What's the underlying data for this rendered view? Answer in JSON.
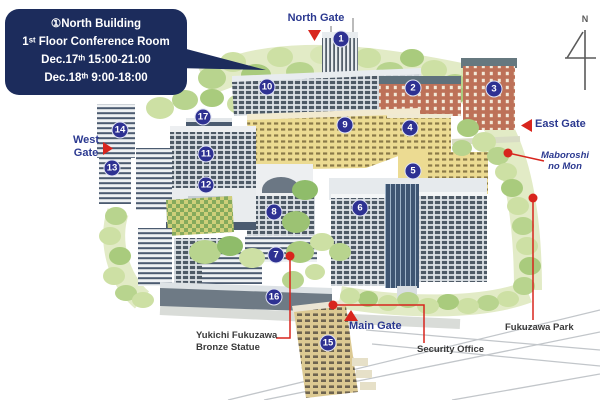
{
  "colors": {
    "marker-bg": "#2e3192",
    "callout-bg": "#1c2c5c",
    "gate-text": "#2b3990",
    "label-text": "#3a3a3a",
    "accent-red": "#d8251d",
    "compass": "#5a5a5a"
  },
  "callout": {
    "line1": "①North Building",
    "line2": "1ˢᵗ Floor Conference Room",
    "line3": "Dec.17ᵗʰ 15:00-21:00",
    "line4": "Dec.18ᵗʰ  9:00-18:00"
  },
  "gates": {
    "north": "North Gate",
    "east": "East Gate",
    "west_line1": "West",
    "west_line2": "Gate",
    "main": "Main Gate"
  },
  "annotations": {
    "maboroshi_line1": "Maboroshi",
    "maboroshi_line2": "no Mon",
    "statue_line1": "Yukichi Fukuzawa",
    "statue_line2": "Bronze Statue",
    "security": "Security Office",
    "park": "Fukuzawa Park"
  },
  "compass": {
    "north_label": "N"
  },
  "markers": [
    {
      "n": "1",
      "x": 341,
      "y": 39
    },
    {
      "n": "2",
      "x": 413,
      "y": 88
    },
    {
      "n": "3",
      "x": 494,
      "y": 89
    },
    {
      "n": "4",
      "x": 410,
      "y": 128
    },
    {
      "n": "5",
      "x": 413,
      "y": 171
    },
    {
      "n": "6",
      "x": 360,
      "y": 208
    },
    {
      "n": "7",
      "x": 276,
      "y": 255
    },
    {
      "n": "8",
      "x": 274,
      "y": 212
    },
    {
      "n": "9",
      "x": 345,
      "y": 125
    },
    {
      "n": "10",
      "x": 267,
      "y": 87
    },
    {
      "n": "11",
      "x": 206,
      "y": 154
    },
    {
      "n": "12",
      "x": 206,
      "y": 185
    },
    {
      "n": "13",
      "x": 112,
      "y": 168
    },
    {
      "n": "14",
      "x": 120,
      "y": 130
    },
    {
      "n": "15",
      "x": 328,
      "y": 343
    },
    {
      "n": "16",
      "x": 274,
      "y": 297
    },
    {
      "n": "17",
      "x": 203,
      "y": 117
    }
  ]
}
